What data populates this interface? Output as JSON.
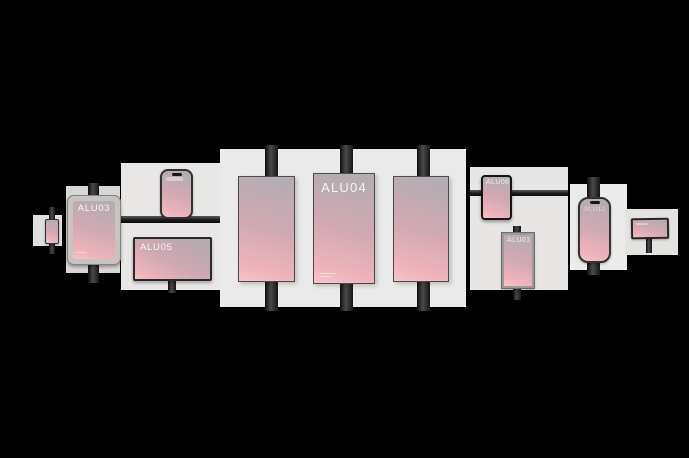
{
  "colors": {
    "background": "#000000",
    "panel_light": "#eaeaea",
    "panel_dark": "#d8d7d6",
    "pole": "#2a2a2a",
    "screen_gradient_top": "#b3acb1",
    "screen_gradient_bottom": "#f5c5c8",
    "label_text": "#ffffff"
  },
  "devices": [
    {
      "id": "mini-phone-left",
      "type": "tiny phone on pole",
      "label": ""
    },
    {
      "id": "tablet-alu03",
      "type": "framed tablet on pole",
      "label": "ALU03"
    },
    {
      "id": "phone-left",
      "type": "smartphone on rail",
      "label": ""
    },
    {
      "id": "monitor-alu05",
      "type": "landscape display on stand",
      "label": "ALU05"
    },
    {
      "id": "poster-left",
      "type": "large vertical screen on pole",
      "label": ""
    },
    {
      "id": "poster-center",
      "type": "large vertical screen on pole",
      "label": "ALU04"
    },
    {
      "id": "poster-right",
      "type": "large vertical screen on pole",
      "label": ""
    },
    {
      "id": "tablet-alu06",
      "type": "small tablet on rail",
      "label": "ALU06"
    },
    {
      "id": "poster-alu01",
      "type": "small framed poster on pole",
      "label": "ALU01"
    },
    {
      "id": "phone-right",
      "type": "smartphone on pole",
      "label": "ALU12"
    },
    {
      "id": "sign-right",
      "type": "small sign on stand",
      "label": ""
    }
  ]
}
